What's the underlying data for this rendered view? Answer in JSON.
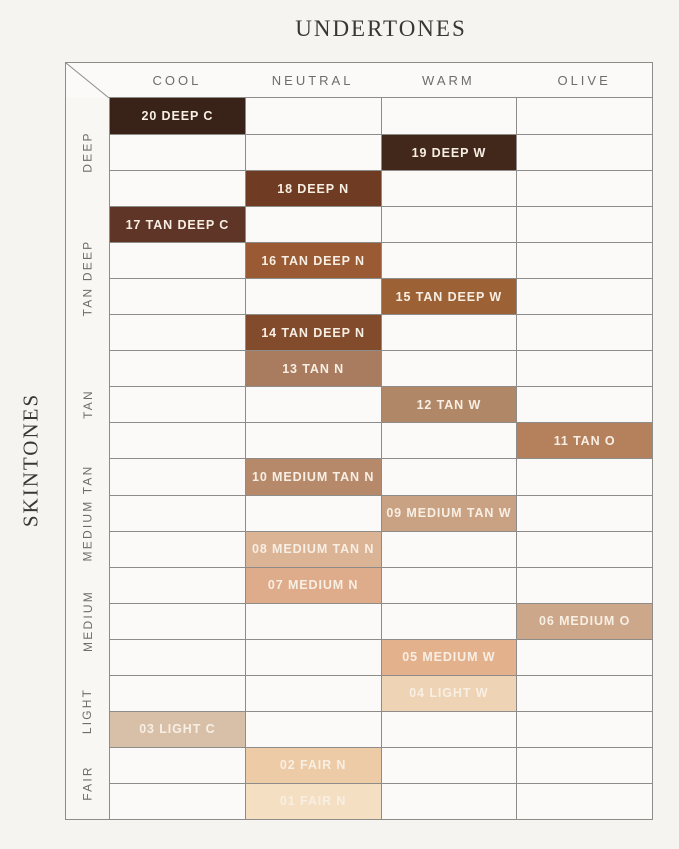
{
  "page": {
    "background": "#f5f4f1"
  },
  "chart_data": {
    "type": "table",
    "title": "UNDERTONES",
    "xlabel": "UNDERTONES",
    "ylabel": "SKINTONES",
    "columns": [
      "COOL",
      "NEUTRAL",
      "WARM",
      "OLIVE"
    ],
    "row_groups": [
      {
        "label": "DEEP",
        "row_span": 3
      },
      {
        "label": "TAN DEEP",
        "row_span": 4
      },
      {
        "label": "TAN",
        "row_span": 3
      },
      {
        "label": "MEDIUM TAN",
        "row_span": 3
      },
      {
        "label": "MEDIUM",
        "row_span": 3
      },
      {
        "label": "LIGHT",
        "row_span": 2
      },
      {
        "label": "FAIR",
        "row_span": 2
      }
    ],
    "rows": [
      {
        "group": "DEEP",
        "shade": "20 DEEP C",
        "column": "COOL",
        "color": "#392318"
      },
      {
        "group": "DEEP",
        "shade": "19 DEEP W",
        "column": "WARM",
        "color": "#41281b"
      },
      {
        "group": "DEEP",
        "shade": "18 DEEP N",
        "column": "NEUTRAL",
        "color": "#6f3b22"
      },
      {
        "group": "TAN DEEP",
        "shade": "17 TAN DEEP C",
        "column": "COOL",
        "color": "#5e3526"
      },
      {
        "group": "TAN DEEP",
        "shade": "16 TAN DEEP N",
        "column": "NEUTRAL",
        "color": "#9a5a33"
      },
      {
        "group": "TAN DEEP",
        "shade": "15 TAN DEEP W",
        "column": "WARM",
        "color": "#9d6136"
      },
      {
        "group": "TAN DEEP",
        "shade": "14 TAN DEEP N",
        "column": "NEUTRAL",
        "color": "#824b2b"
      },
      {
        "group": "TAN",
        "shade": "13 TAN N",
        "column": "NEUTRAL",
        "color": "#a97b5f"
      },
      {
        "group": "TAN",
        "shade": "12 TAN W",
        "column": "WARM",
        "color": "#b18867"
      },
      {
        "group": "TAN",
        "shade": "11 TAN O",
        "column": "OLIVE",
        "color": "#b5815c"
      },
      {
        "group": "MEDIUM TAN",
        "shade": "10 MEDIUM TAN N",
        "column": "NEUTRAL",
        "color": "#b6896a"
      },
      {
        "group": "MEDIUM TAN",
        "shade": "09 MEDIUM TAN W",
        "column": "WARM",
        "color": "#c9a183"
      },
      {
        "group": "MEDIUM TAN",
        "shade": "08 MEDIUM TAN N",
        "column": "NEUTRAL",
        "color": "#dbb395"
      },
      {
        "group": "MEDIUM",
        "shade": "07 MEDIUM N",
        "column": "NEUTRAL",
        "color": "#deac8a"
      },
      {
        "group": "MEDIUM",
        "shade": "06 MEDIUM O",
        "column": "OLIVE",
        "color": "#cda78a"
      },
      {
        "group": "MEDIUM",
        "shade": "05 MEDIUM W",
        "column": "WARM",
        "color": "#e3b28d"
      },
      {
        "group": "LIGHT",
        "shade": "04 LIGHT W",
        "column": "WARM",
        "color": "#eed3b5"
      },
      {
        "group": "LIGHT",
        "shade": "03 LIGHT C",
        "column": "COOL",
        "color": "#d8bfa7"
      },
      {
        "group": "FAIR",
        "shade": "02 FAIR N",
        "column": "NEUTRAL",
        "color": "#edcba6"
      },
      {
        "group": "FAIR",
        "shade": "01 FAIR N",
        "column": "NEUTRAL",
        "color": "#f4dfc3"
      }
    ],
    "styles": {
      "grid_line_color": "#8e8c89",
      "cell_background": "#fbfaf8",
      "shade_text_color": "#f8efe4",
      "header_text_color": "#6f6d69",
      "title_text_color": "#393731"
    },
    "layout": {
      "legend": "none",
      "grid": "on"
    }
  }
}
